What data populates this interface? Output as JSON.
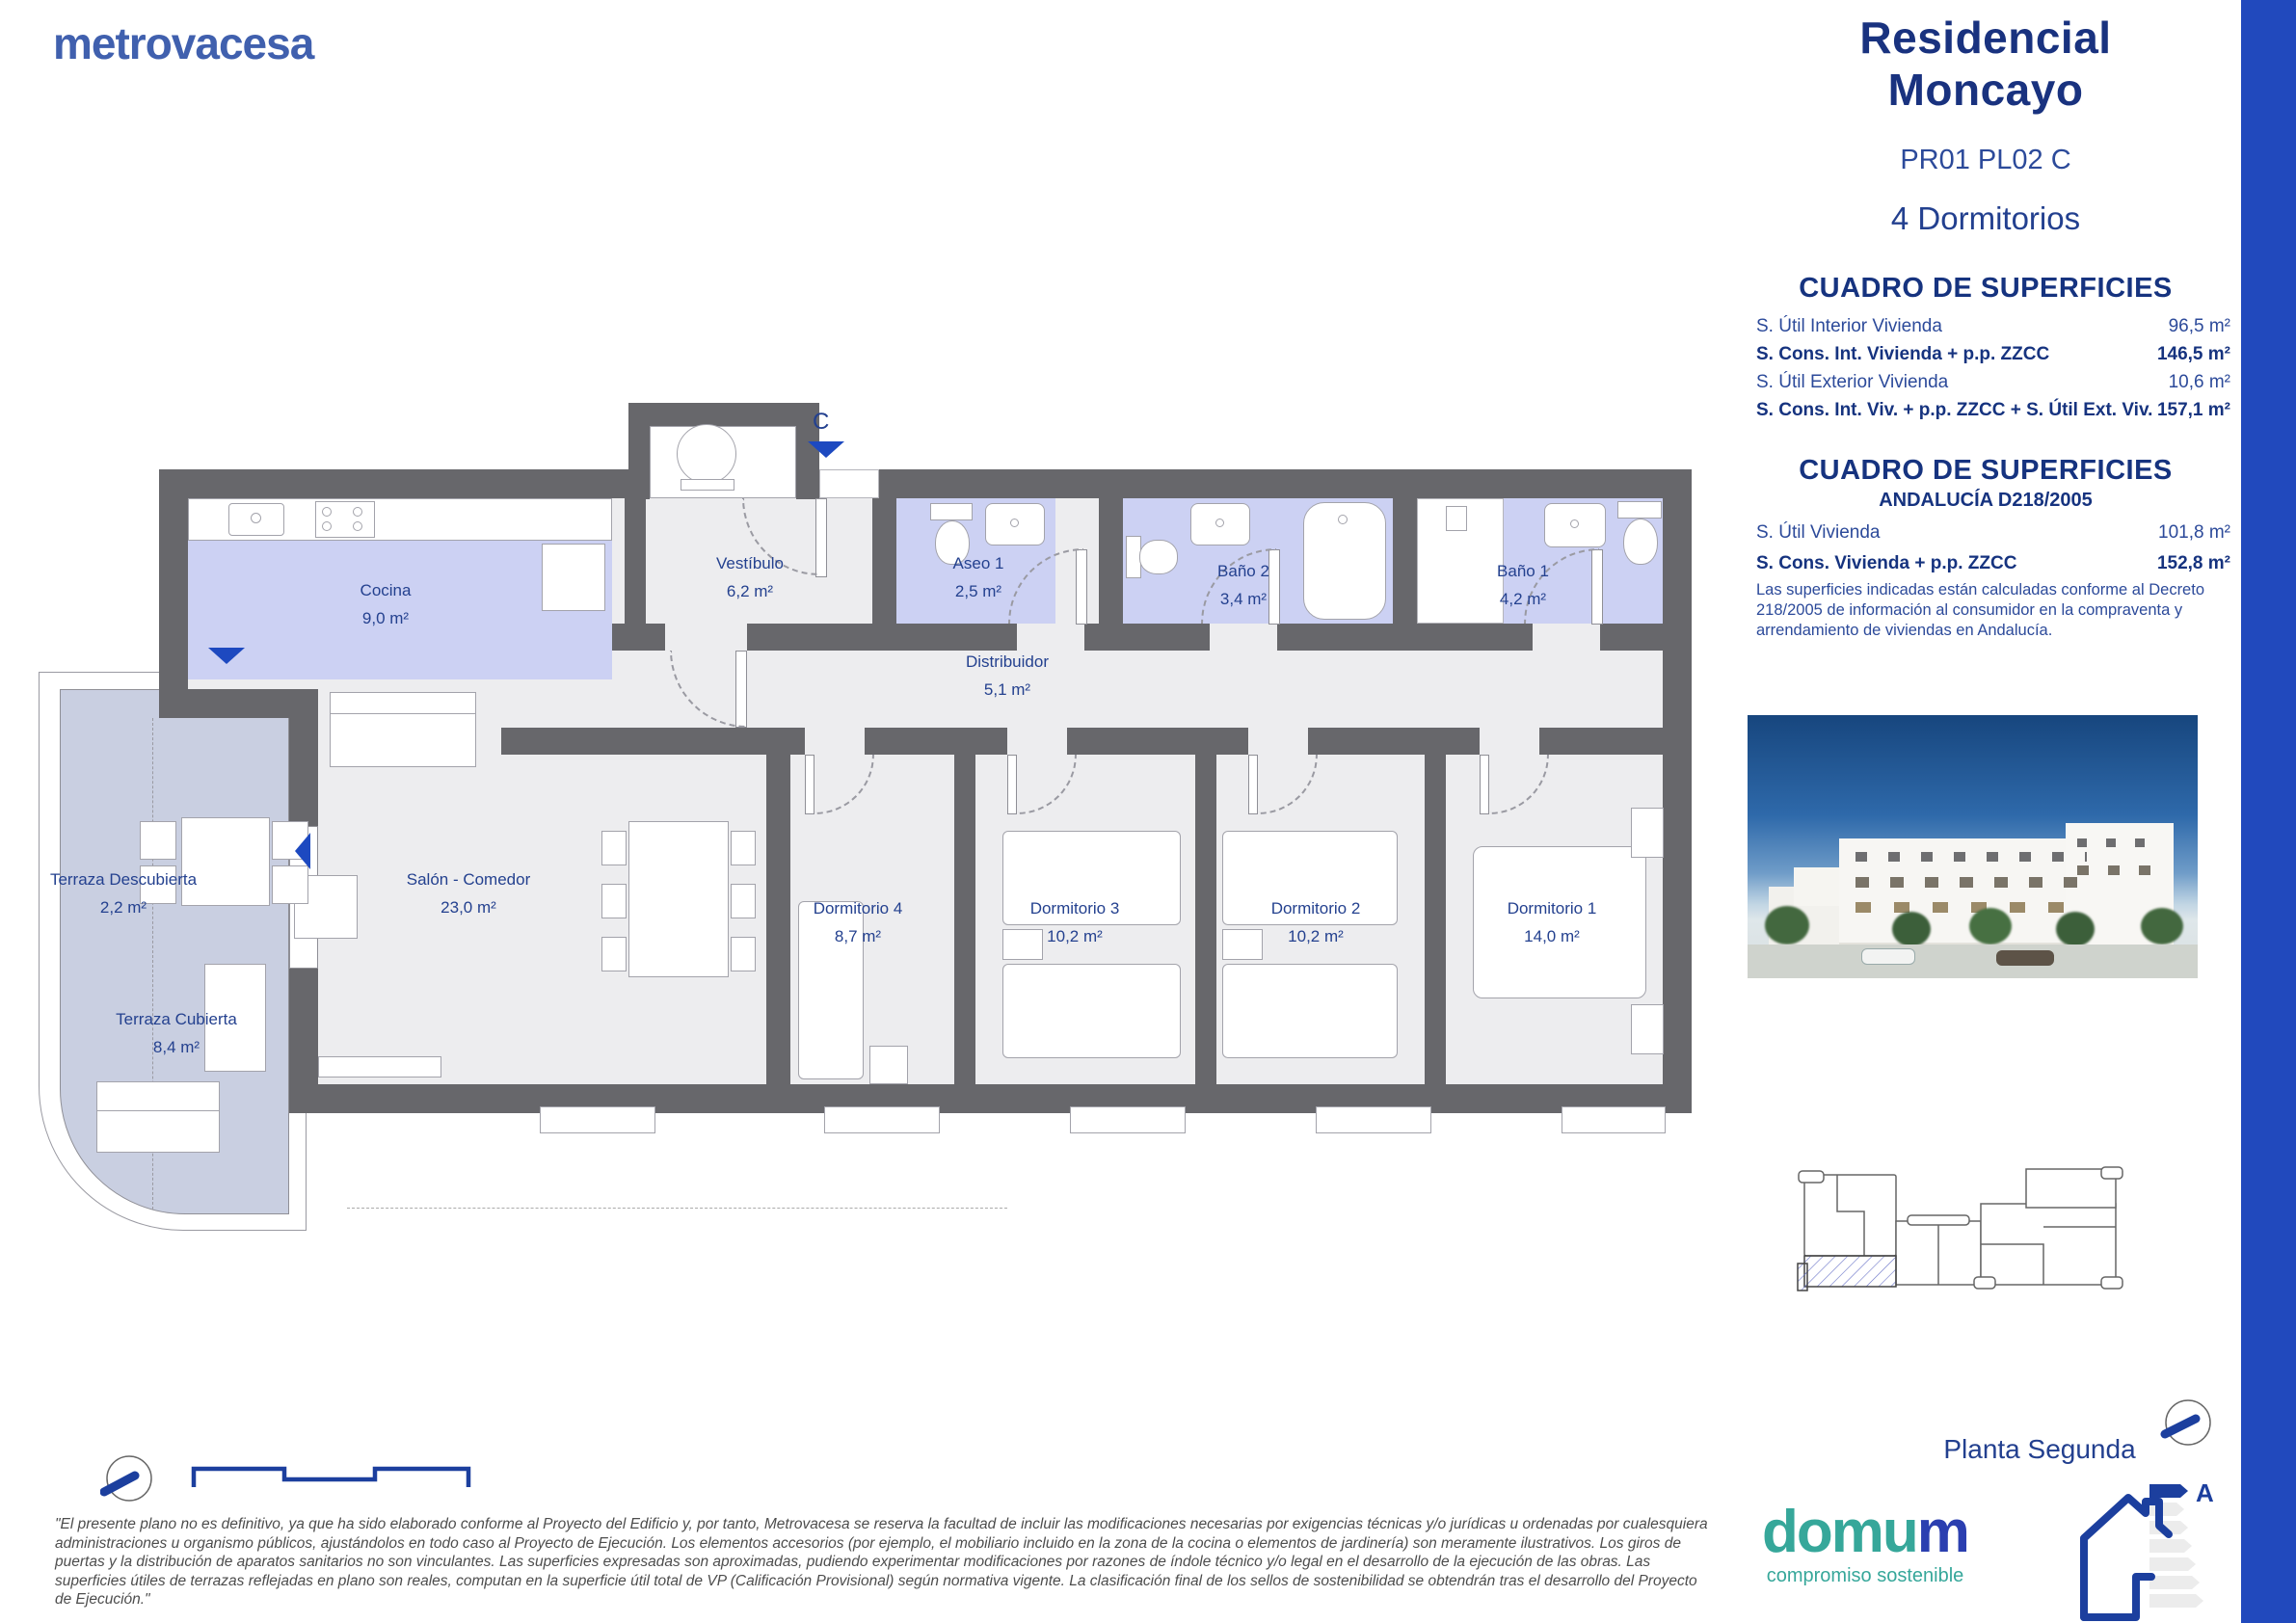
{
  "page": {
    "accent_bar_color": "#2149bd"
  },
  "brand": {
    "logo_text": "metrovacesa"
  },
  "header": {
    "title_line1": "Residencial",
    "title_line2": "Moncayo",
    "plan_code": "PR01 PL02 C",
    "bedrooms_label": "4 Dormitorios"
  },
  "surface_table_main": {
    "title": "CUADRO DE SUPERFICIES",
    "rows": [
      {
        "label": "S. Útil Interior Vivienda",
        "value": "96,5 m²"
      },
      {
        "label": "S. Cons. Int. Vivienda + p.p. ZZCC",
        "value": "146,5 m²"
      },
      {
        "label": "S. Útil Exterior Vivienda",
        "value": "10,6 m²"
      },
      {
        "label": "S. Cons. Int. Viv. + p.p. ZZCC + S. Útil Ext. Viv.",
        "value": "157,1 m²"
      }
    ]
  },
  "surface_table_andalucia": {
    "title": "CUADRO DE SUPERFICIES",
    "subtitle": "ANDALUCÍA D218/2005",
    "rows": [
      {
        "label": "S. Útil Vivienda",
        "value": "101,8 m²"
      },
      {
        "label": "S. Cons. Vivienda + p.p. ZZCC",
        "value": "152,8 m²"
      }
    ],
    "note": "Las superficies indicadas están calculadas conforme al Decreto 218/2005 de información al consumidor en la compraventa y arrendamiento de viviendas en Andalucía."
  },
  "floorplan": {
    "entrance_label": "C",
    "rooms": [
      {
        "name": "Cocina",
        "area": "9,0 m²"
      },
      {
        "name": "Vestíbulo",
        "area": "6,2 m²"
      },
      {
        "name": "Aseo 1",
        "area": "2,5 m²"
      },
      {
        "name": "Baño 2",
        "area": "3,4 m²"
      },
      {
        "name": "Baño 1",
        "area": "4,2 m²"
      },
      {
        "name": "Distribuidor",
        "area": "5,1 m²"
      },
      {
        "name": "Terraza Descubierta",
        "area": "2,2 m²"
      },
      {
        "name": "Salón - Comedor",
        "area": "23,0 m²"
      },
      {
        "name": "Terraza Cubierta",
        "area": "8,4 m²"
      },
      {
        "name": "Dormitorio 4",
        "area": "8,7 m²"
      },
      {
        "name": "Dormitorio 3",
        "area": "10,2 m²"
      },
      {
        "name": "Dormitorio 2",
        "area": "10,2 m²"
      },
      {
        "name": "Dormitorio 1",
        "area": "14,0 m²"
      }
    ]
  },
  "keyplan": {
    "caption": "Planta Segunda"
  },
  "energy": {
    "rating": "A"
  },
  "domum": {
    "logo_main": "domu",
    "logo_accent": "m",
    "tagline": "compromiso sostenible"
  },
  "disclaimer": {
    "text": "\"El presente plano no es definitivo, ya que ha sido elaborado conforme al Proyecto del Edificio y, por tanto, Metrovacesa se reserva la facultad de incluir las modificaciones necesarias por exigencias técnicas y/o jurídicas u ordenadas por cualesquiera administraciones u organismo públicos, ajustándolos en todo caso al Proyecto de Ejecución. Los elementos accesorios (por ejemplo, el mobiliario incluido en la zona de la cocina o elementos de jardinería) son meramente ilustrativos. Los giros de puertas y la distribución de aparatos sanitarios no son vinculantes. Las superficies expresadas son aproximadas, pudiendo experimentar modificaciones por razones de índole técnico y/o legal en el desarrollo de la ejecución de las obras. Las superficies útiles de terrazas reflejadas en plano son reales, computan en la superficie útil total de VP (Calificación Provisional) según normativa vigente. La clasificación final de los sellos de sostenibilidad se obtendrán tras el desarrollo del Proyecto de Ejecución.\""
  }
}
